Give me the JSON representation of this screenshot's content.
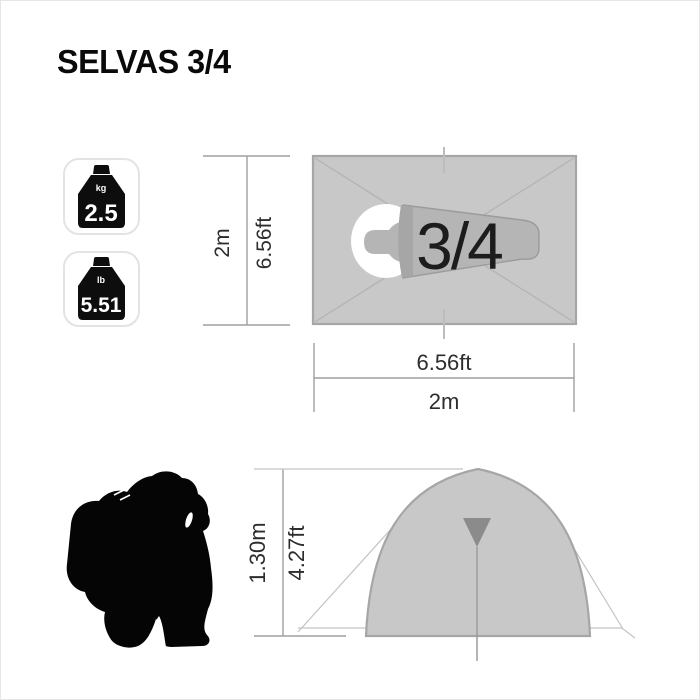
{
  "title": "SELVAS 3/4",
  "weights": {
    "kg": {
      "unit": "kg",
      "value": "2.5"
    },
    "lb": {
      "unit": "lb",
      "value": "5.51"
    }
  },
  "top_view": {
    "capacity": "3/4",
    "side_m": "2m",
    "side_ft": "6.56ft",
    "front_ft": "6.56ft",
    "front_m": "2m"
  },
  "side_view": {
    "height_m": "1.30m",
    "height_ft": "4.27ft"
  },
  "colors": {
    "tent_fill": "#c8c8c8",
    "tent_stroke": "#a6a6a6",
    "bag_body_fill": "#b5b5b5",
    "bag_body_stroke": "#9b9b9b",
    "bag_fold_fill": "#a6a6a6",
    "diagonal_gray": "#b3b3b3",
    "door_marker_gray": "#8b8b8b",
    "silhouette_black": "#050505",
    "weight_black": "#0d0d0d"
  }
}
